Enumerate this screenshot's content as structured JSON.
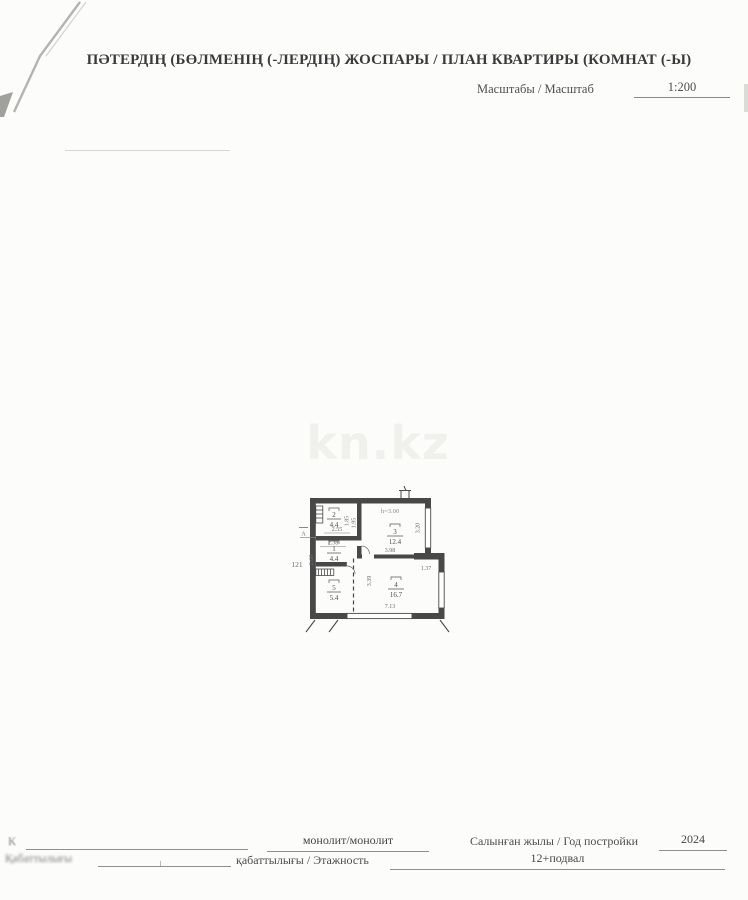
{
  "page": {
    "title": "ПӘТЕРДІҢ (БӨЛМЕНІҢ (-ЛЕРДІҢ) ЖОСПАРЫ / ПЛАН КВАРТИРЫ (КОМНАТ (-Ы)",
    "scale_label": "Масштабы / Масштаб",
    "scale_value": "1:200",
    "watermark": "kn.kz"
  },
  "plan": {
    "unit_number": "121",
    "ceiling_height": "h=3.00",
    "section_mark": "А",
    "rooms": [
      {
        "number": "1",
        "area": "4.4"
      },
      {
        "number": "2",
        "area": "4.4"
      },
      {
        "number": "3",
        "area": "12.4"
      },
      {
        "number": "4",
        "area": "16.7"
      },
      {
        "number": "5",
        "area": "5.4"
      }
    ],
    "dims": {
      "d255": "2.55",
      "d238": "2.38",
      "d185": "1.85",
      "d195": "1.95",
      "d320": "3.20",
      "d260": "2.60",
      "d398": "3.98",
      "d137": "1.37",
      "d339": "3.39",
      "d713": "7.13"
    }
  },
  "footer": {
    "row1_left_faded": "К",
    "wall_material_value": "монолит/монолит",
    "year_label": "Салынған жылы / Год постройки",
    "year_value": "2024",
    "row2_left_faded": "Қабаттылығы",
    "floors_label": "қабаттылығы / Этажность",
    "floors_value": "12+подвал"
  },
  "colors": {
    "ink": "#3a3a3a",
    "plan_wall": "#484848",
    "dim_text": "#6b6b6b",
    "watermark": "#f0f0ed"
  }
}
